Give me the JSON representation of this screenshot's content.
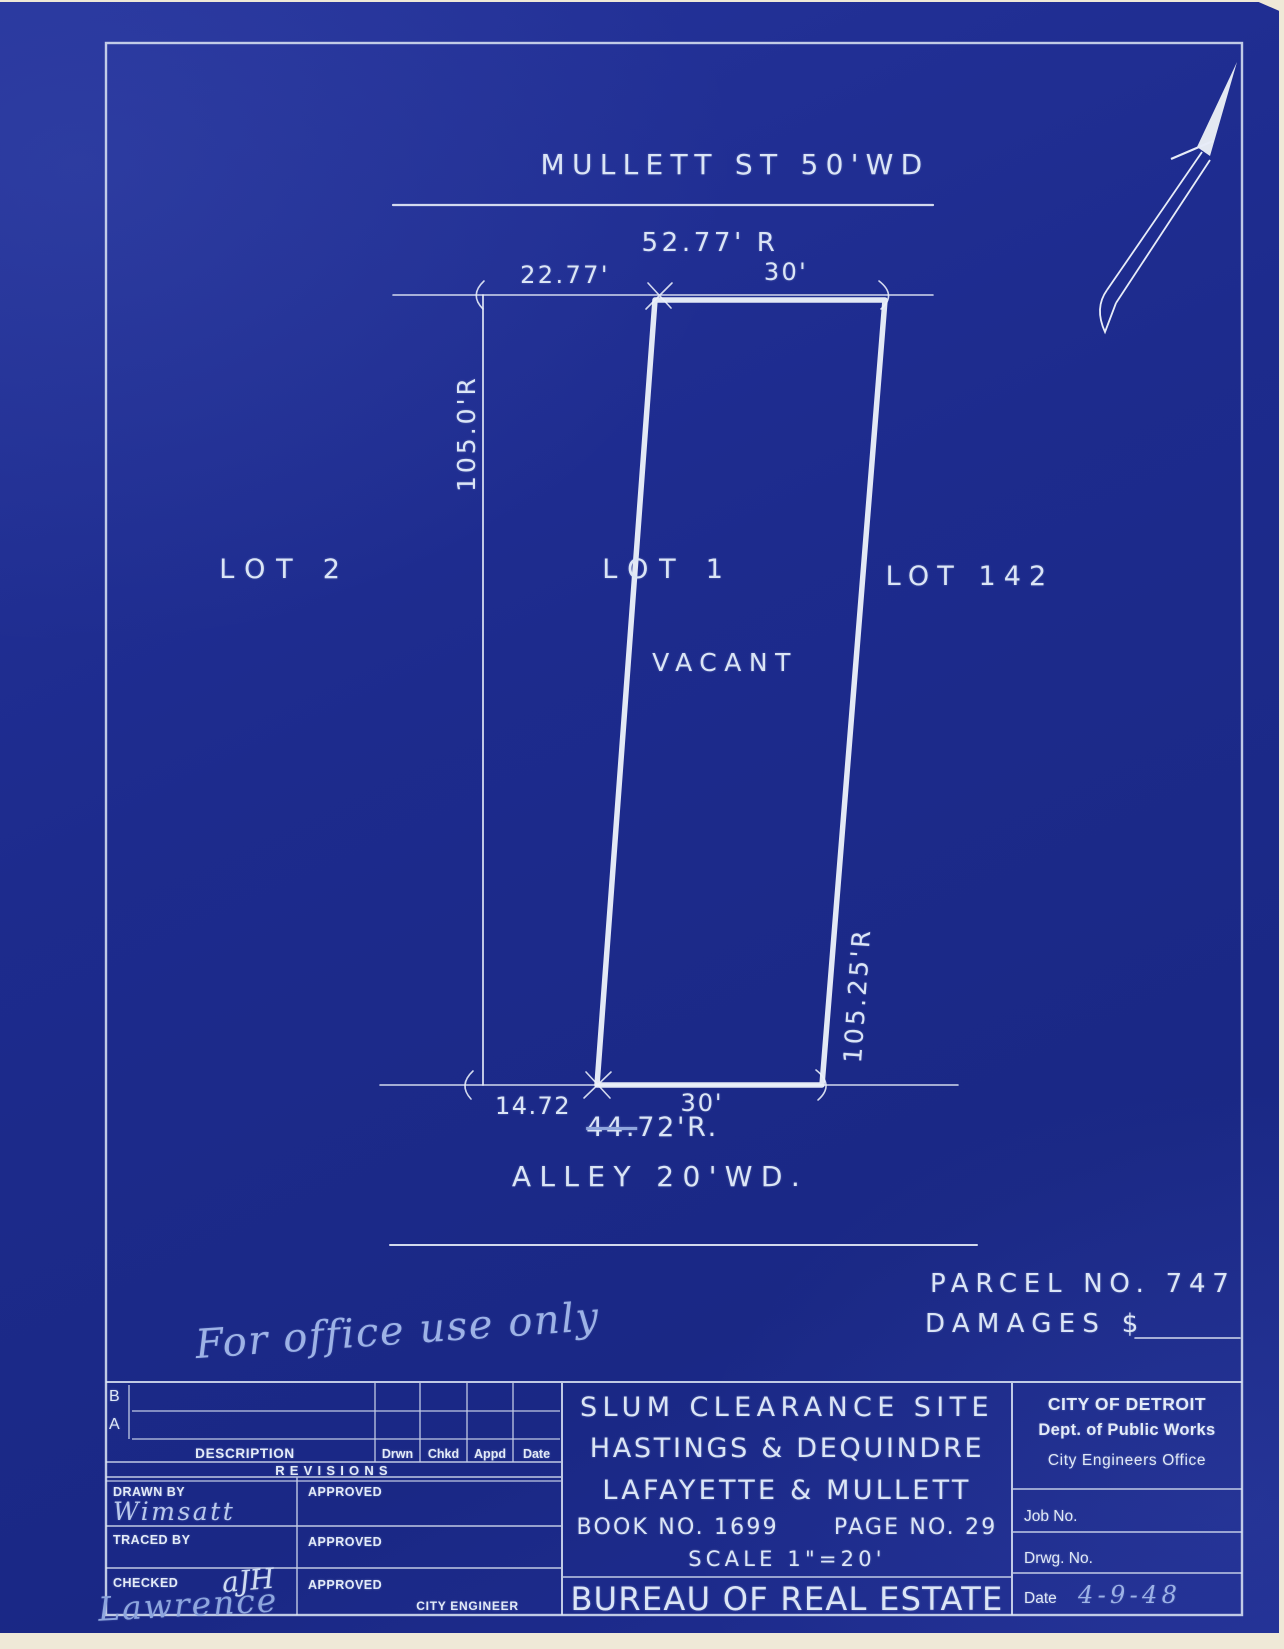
{
  "colors": {
    "sheet_blue": "#1d2b8d",
    "line_white": "#e7ecf8",
    "pencil_blue": "#9db2e6",
    "paper_edge": "#efe9d7"
  },
  "plan": {
    "street_top": "MULLETT ST 50'WD",
    "street_frontage": "52.77' R",
    "dim_left_top": "22.77'",
    "dim_right_top": "30'",
    "depth_left": "105.0'R",
    "depth_right": "105.25'R",
    "lot_left": "LOT 2",
    "lot_center": "LOT 1",
    "lot_right": "LOT 142",
    "status": "VACANT",
    "dim_left_bottom": "14.72",
    "dim_right_bottom": "30'",
    "rear_dim_struck": "44.",
    "rear_dim_rest": "72'R.",
    "alley": "ALLEY 20'WD.",
    "parcel_no": "PARCEL NO. 747",
    "damages": "DAMAGES $",
    "office_note": "For office use only"
  },
  "titleblock": {
    "rev_b": "B",
    "rev_a": "A",
    "col_description": "DESCRIPTION",
    "col_drwn": "Drwn",
    "col_chkd": "Chkd",
    "col_appd": "Appd",
    "col_date": "Date",
    "revisions": "REVISIONS",
    "drawn_by": "DRAWN BY",
    "drawn_by_value": "Wimsatt",
    "traced_by": "TRACED BY",
    "checked": "CHECKED",
    "checked_initials": "aJH",
    "checked_signature": "Lawrence",
    "approved_1": "APPROVED",
    "approved_2": "APPROVED",
    "approved_3": "APPROVED",
    "city_engineer": "CITY ENGINEER",
    "project_line1": "SLUM CLEARANCE SITE",
    "project_line2": "HASTINGS & DEQUINDRE",
    "project_line3": "LAFAYETTE & MULLETT",
    "book_page": "BOOK NO. 1699      PAGE NO. 29",
    "scale": "SCALE 1\"=20'",
    "bureau": "BUREAU OF REAL ESTATE",
    "org_line1": "CITY OF DETROIT",
    "org_line2": "Dept. of Public Works",
    "org_line3": "City Engineers Office",
    "job_no": "Job No.",
    "drwg_no": "Drwg. No.",
    "date_label": "Date",
    "date_value": "4-9-48"
  }
}
